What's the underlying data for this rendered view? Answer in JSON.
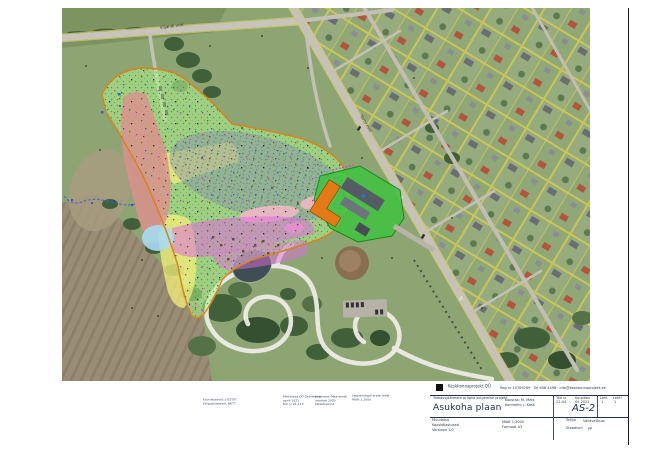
{
  "page": {
    "background": "#ffffff",
    "frame_color": "#1a1a1a"
  },
  "map": {
    "road_label_top": "Viljandi mnt",
    "road_label_diagonal": "Tartu mnt",
    "colors": {
      "site_boundary": "#d9831f",
      "zone_green": "#b0f08e",
      "zone_red": "#e08e8e",
      "zone_yellow": "#f4ef7a",
      "zone_magenta": "#df6ede",
      "zone_pink": "#f4b8c8",
      "zone_blue": "#a8daf2",
      "landfill_gray": "#8a98a2",
      "facility_green": "#3ec23e",
      "building_orange": "#e57916",
      "cadastral_yellow": "#d8cc4e"
    }
  },
  "footnotes": {
    "block1": [
      "Koordinaadid: L-EST97",
      "Kõrgussüsteem: BK77"
    ],
    "block2": [
      "Mõõdistas OÜ Geodeesia",
      "aprill 2021",
      "töö nr 21-113"
    ],
    "block3": [
      "Aluskaart: Maa-ameti",
      "ortofoto 2020",
      "katastripiirid"
    ],
    "block4": [
      "Leppemärgid eraldi lehel",
      "Mõõt 1:2000"
    ]
  },
  "titleblock": {
    "company": "Keskkonnaprojekt OÜ",
    "company_info": "Reg nr 10769769 · Tel 656 4498 · info@keskkonnaprojekt.ee",
    "project_line1": "Tööstusjäätmete prügila sulgemise projekt",
    "drawing_title": "Asukoha plaan",
    "center_note1": "Koostas: M. Mets",
    "center_note2": "Kontrollis: J. Kask",
    "grid": {
      "label1": "Töö nr",
      "value1": "21-04",
      "label2": "Kuupäev",
      "value2": "05.2021",
      "label3": "Leht",
      "value3": "1",
      "label4": "Lehti",
      "value4": "1"
    },
    "sheet_no": "AS-2",
    "left_note1": "Muudatus",
    "left_note2": "Kooskõlastused",
    "left_note3": "Versioon 1.0",
    "client_label": "Tellija",
    "client_value": "Vallavalitsus",
    "stage_label": "Staadium",
    "stage_value": "PP",
    "bottom_note1": "Mõõt 1:2000",
    "bottom_note2": "Formaat A3"
  }
}
